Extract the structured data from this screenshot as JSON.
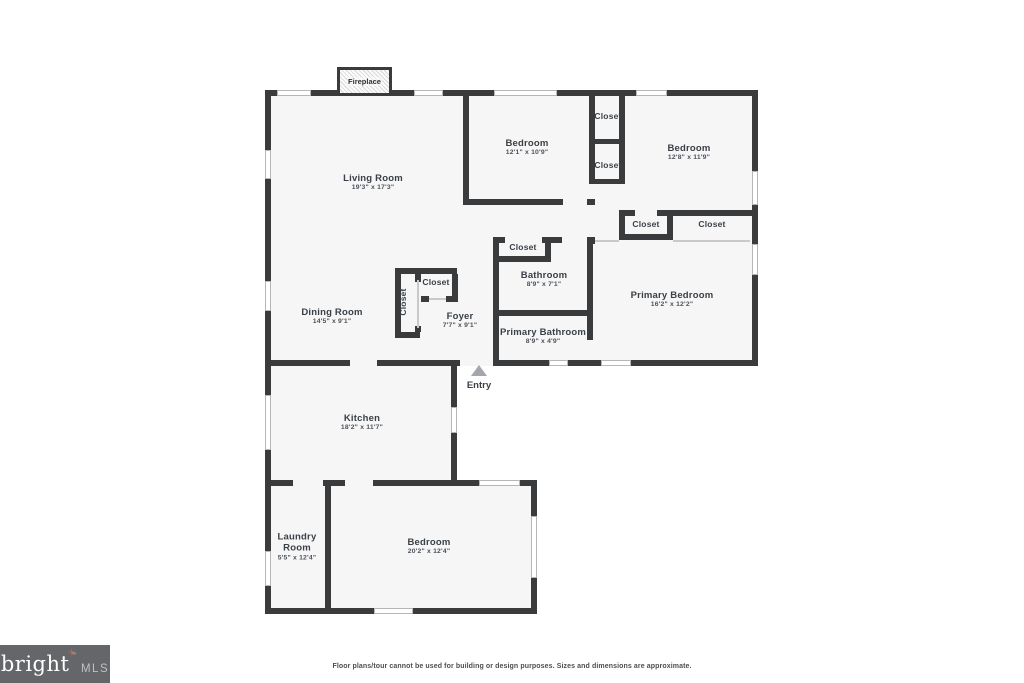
{
  "plan": {
    "fireplace_label": "Fireplace",
    "entry_label": "Entry",
    "rooms": [
      {
        "name": "Living Room",
        "dims": "19'3\" x 17'3\""
      },
      {
        "name": "Bedroom",
        "dims": "12'1\" x 10'9\""
      },
      {
        "name": "Bedroom",
        "dims": "12'8\" x 11'9\""
      },
      {
        "name": "Dining Room",
        "dims": "14'5\" x 9'1\""
      },
      {
        "name": "Foyer",
        "dims": "7'7\" x 9'1\""
      },
      {
        "name": "Bathroom",
        "dims": "8'9\" x 7'1\""
      },
      {
        "name": "Primary Bathroom",
        "dims": "8'9\" x 4'9\""
      },
      {
        "name": "Primary Bedroom",
        "dims": "16'2\" x 12'2\""
      },
      {
        "name": "Kitchen",
        "dims": "18'2\" x 11'7\""
      },
      {
        "name": "Laundry Room",
        "dims": "5'5\" x 12'4\""
      },
      {
        "name": "Bedroom",
        "dims": "20'2\" x 12'4\""
      }
    ],
    "closet_labels": [
      "Closet",
      "Closet",
      "Closet",
      "Closet",
      "Closet",
      "Closet",
      "Closet"
    ]
  },
  "footer": {
    "disclaimer": "Floor plans/tour cannot be used for building or design purposes. Sizes and dimensions are approximate.",
    "logo": {
      "brand": "bright",
      "suffix": "MLS",
      "trademark": "™",
      "accent_glyph": "+",
      "accent_color": "#e05a2b",
      "bg_color": "#646669"
    }
  }
}
